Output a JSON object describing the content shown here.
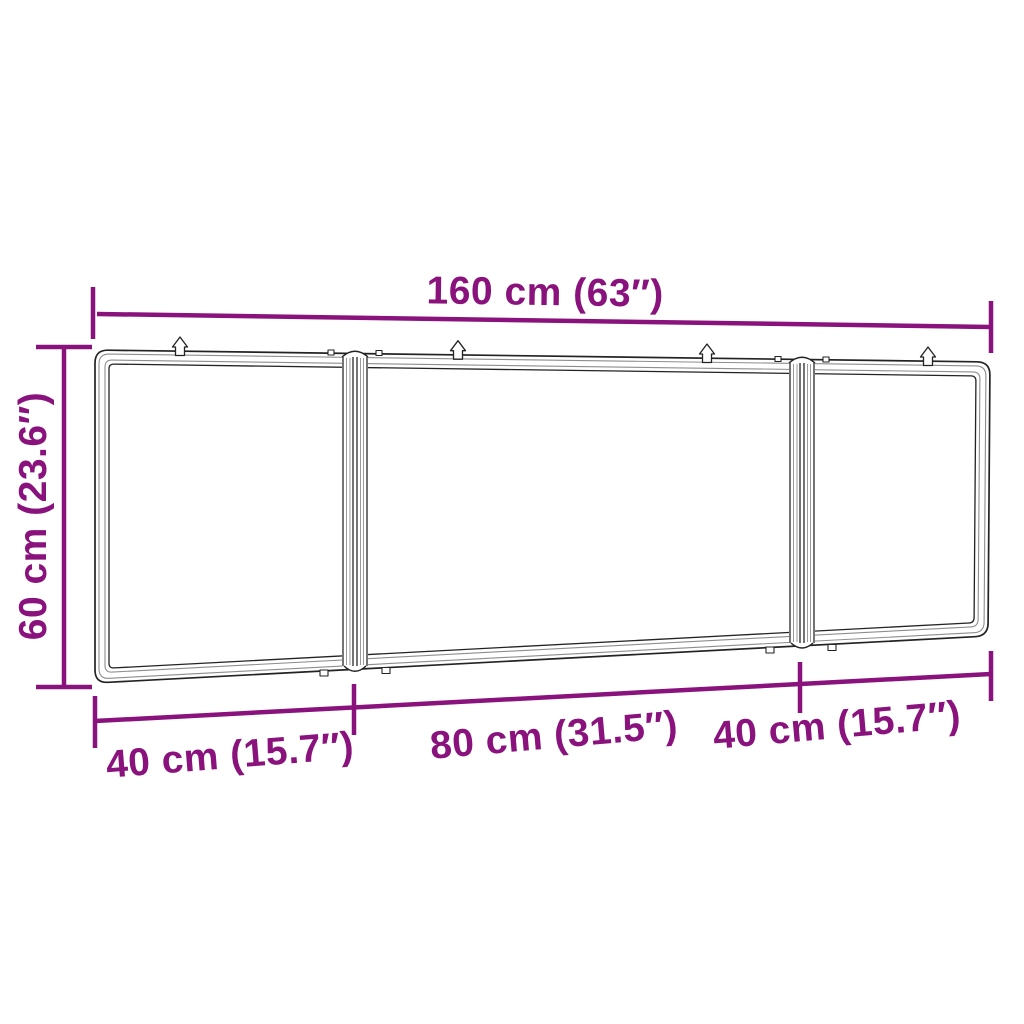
{
  "diagram": {
    "colors": {
      "dimension_accent": "#8a127d",
      "line_art_dark": "#232323",
      "line_art_light": "#9a9a9a",
      "background": "#ffffff"
    },
    "dimensions": {
      "width_total": {
        "label": "160 cm (63″)"
      },
      "height": {
        "label": "60 cm (23.6″)"
      },
      "bottom_segments": [
        {
          "label": "40 cm (15.7″)"
        },
        {
          "label": "80 cm (31.5″)"
        },
        {
          "label": "40 cm (15.7″)"
        }
      ]
    }
  }
}
